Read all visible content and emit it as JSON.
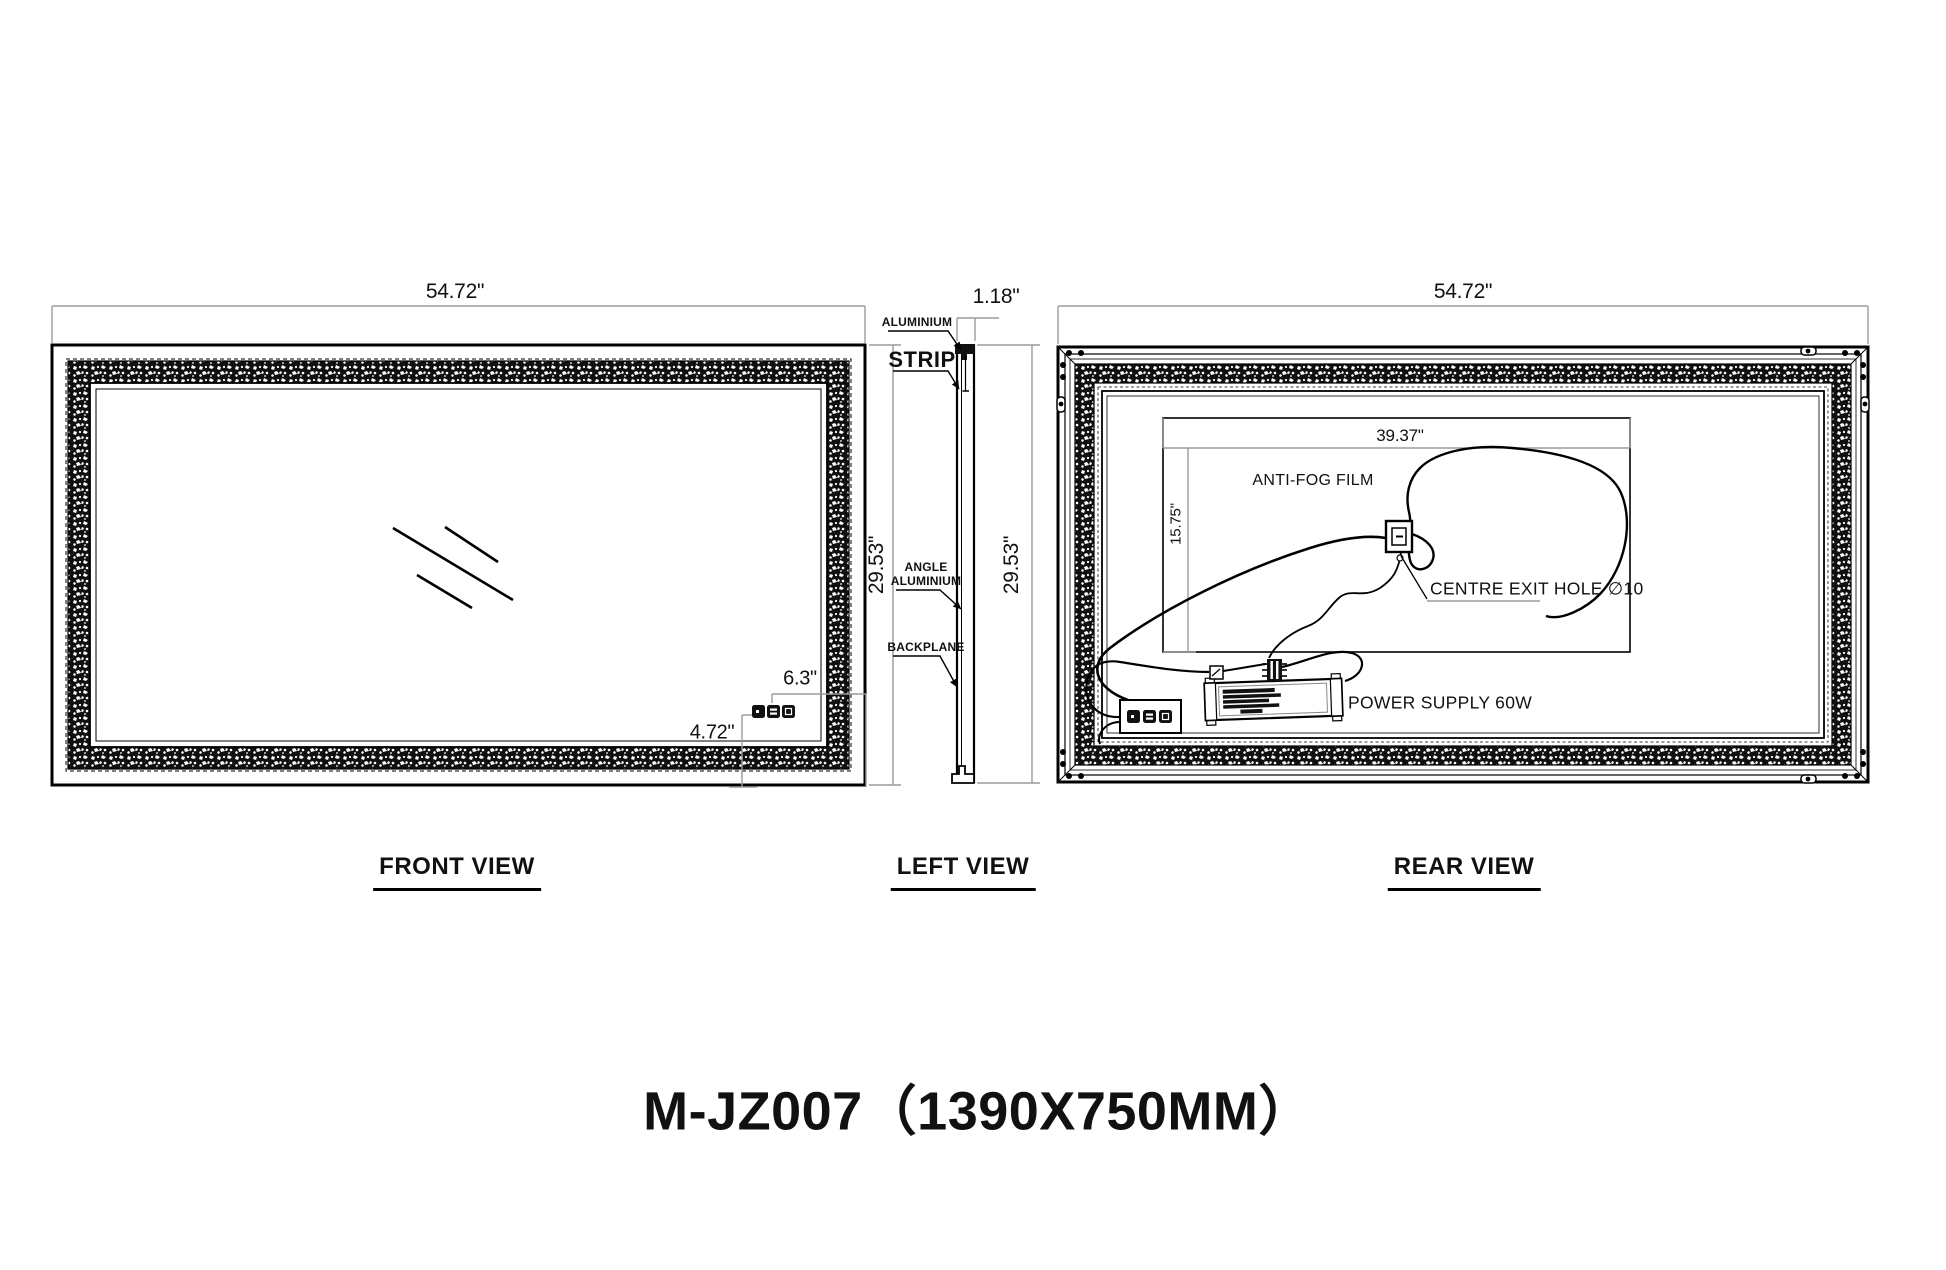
{
  "product": {
    "title": "M-JZ007（1390X750MM）"
  },
  "front_view": {
    "label": "FRONT VIEW",
    "width_dim": "54.72\"",
    "height_dim": "29.53\"",
    "sensor_offset_right_dim": "6.3\"",
    "sensor_offset_bottom_dim": "4.72\""
  },
  "left_view": {
    "label": "LEFT VIEW",
    "thickness_dim": "1.18\"",
    "height_dim": "29.53\"",
    "callout_aluminium": "ALUMINIUM",
    "callout_strip": "STRIP",
    "callout_angle_line1": "ANGLE",
    "callout_angle_line2": "ALUMINIUM",
    "callout_backplane": "BACKPLANE"
  },
  "rear_view": {
    "label": "REAR VIEW",
    "width_dim": "54.72\"",
    "film_width_dim": "39.37\"",
    "film_height_dim": "15.75\"",
    "callout_anti_fog": "ANTI-FOG FILM",
    "callout_exit_hole": "CENTRE EXIT HOLE ∅10",
    "callout_power_supply": "POWER SUPPLY 60W"
  }
}
